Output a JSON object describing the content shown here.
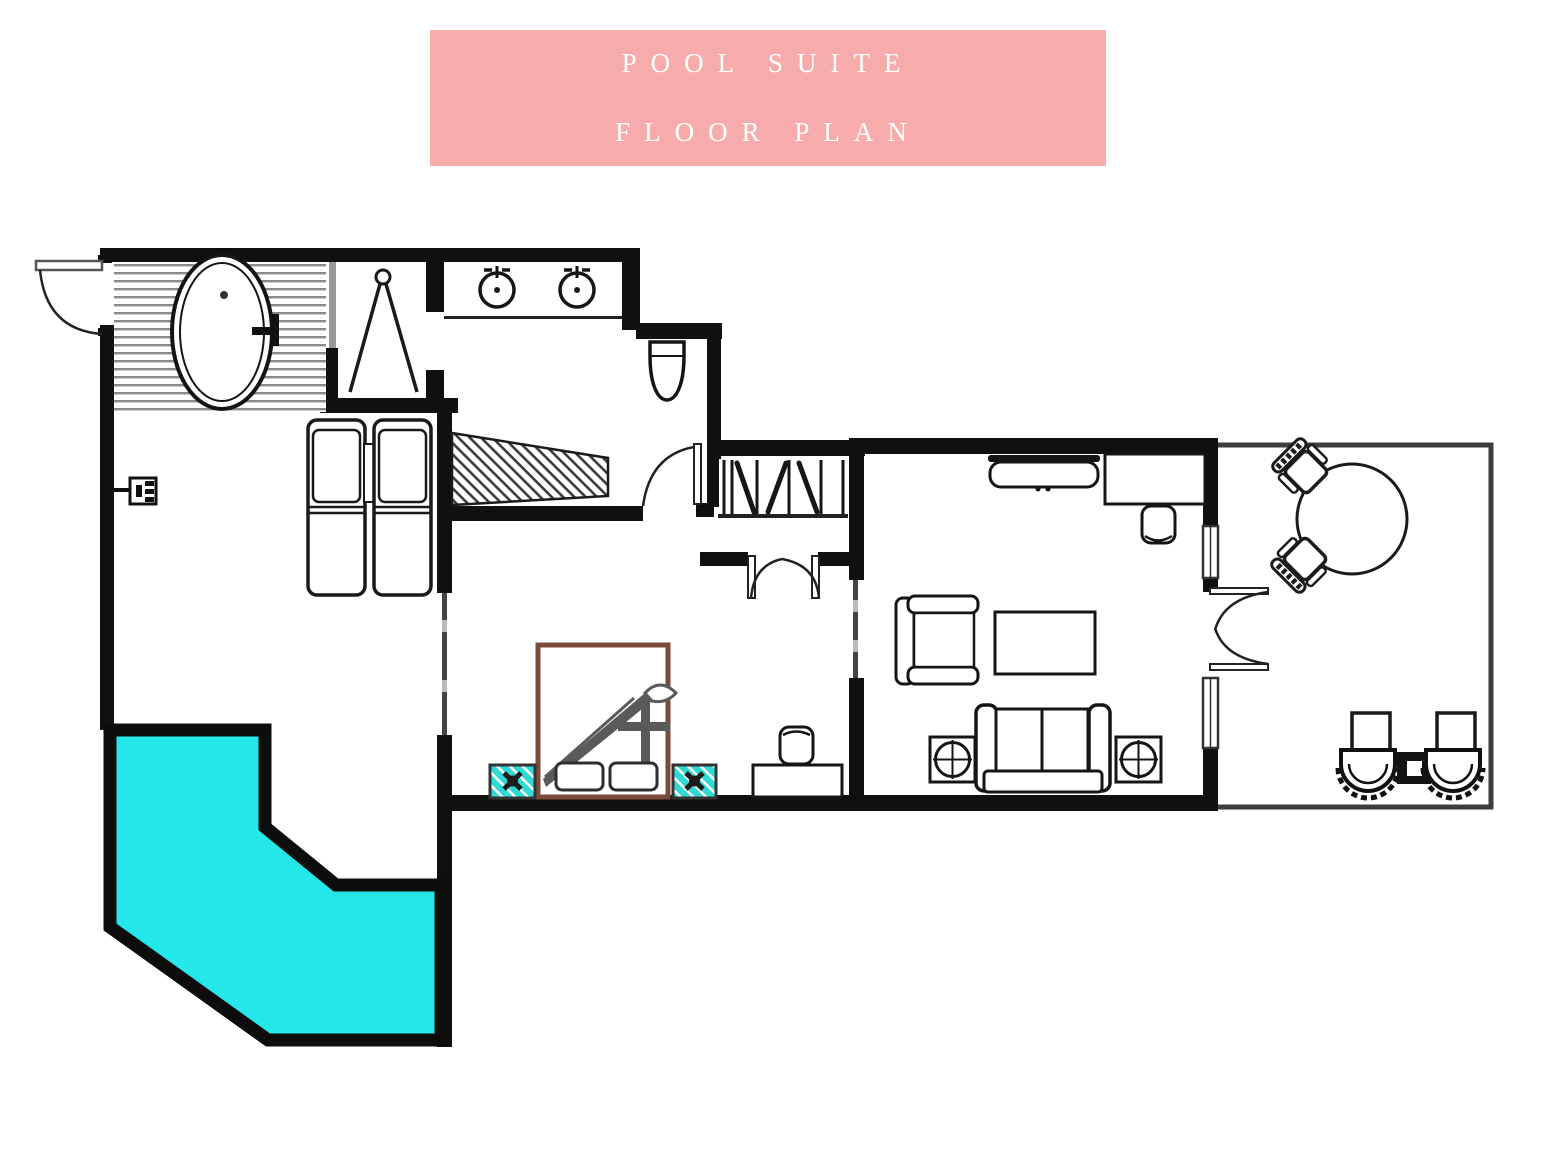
{
  "banner": {
    "title_line1": "POOL SUITE",
    "title_line2": "FLOOR PLAN",
    "background_color": "#F7ABAB",
    "text_color": "#FFFFFF"
  },
  "colors": {
    "pool_water": "#25E6E9",
    "walls": "#101010",
    "bed_frame": "#7B4A38",
    "nightstand_teal": "#2EDAD6",
    "deck_stripe": "#8a8a8a",
    "hatch_line": "#3c3c3c",
    "terrace_border": "#3d3d3d",
    "drape_gray": "#5a5a5a"
  },
  "plan": {
    "symbols": [
      "entry-door",
      "bathtub",
      "outdoor-shower-valve",
      "shower",
      "double-vanity-sinks",
      "toilet",
      "luggage-bench",
      "wardrobe",
      "sun-loungers",
      "private-pool",
      "bed",
      "nightstands",
      "bedroom-writing-desk",
      "tv-console",
      "living-desk",
      "armchair",
      "coffee-table",
      "sofa",
      "side-tables",
      "terrace-round-table",
      "terrace-chairs",
      "terrace-lounge-chairs"
    ]
  }
}
